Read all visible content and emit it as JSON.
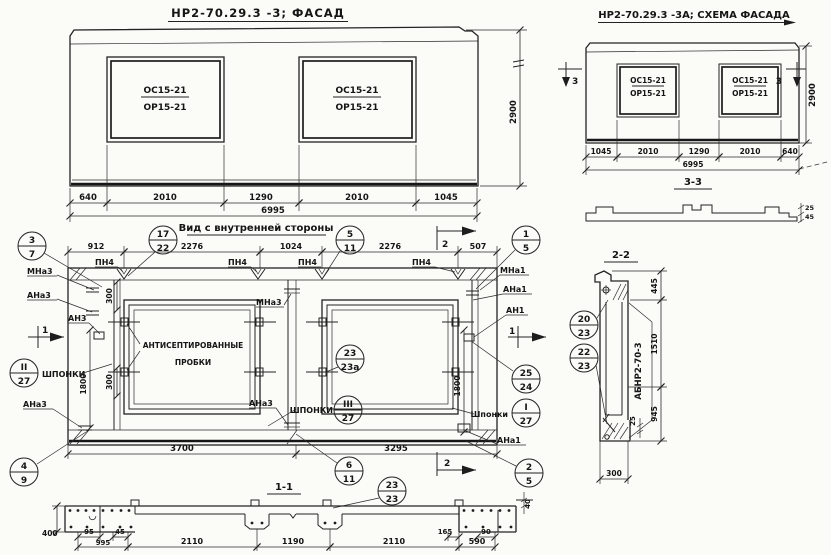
{
  "palette": {
    "ink": "#232323",
    "paper": "#fbfbf8"
  },
  "facade": {
    "title": "НР2-70.29.3 -3;  ФАСАД",
    "opening_top": "ОС15-21",
    "opening_bottom": "ОР15-21",
    "dims": [
      "640",
      "2010",
      "1290",
      "2010",
      "1045"
    ],
    "total": "6995",
    "height": "2900"
  },
  "scheme": {
    "title": "НР2-70.29.3 -3А; СХЕМА ФАСАДА",
    "opening_top": "ОС15-21",
    "opening_bottom": "ОР15-21",
    "dims": [
      "1045",
      "2010",
      "1290",
      "2010",
      "640"
    ],
    "total": "6995",
    "height": "2900",
    "section_mark": "3",
    "section_title": "3-3",
    "edge_dims": [
      "25",
      "45"
    ]
  },
  "interior": {
    "title": "Вид с внутренней стороны",
    "top_dims": [
      "912",
      "2276",
      "1024",
      "2276",
      "507"
    ],
    "bottom_dims": [
      "3700",
      "3295"
    ],
    "dim_300": "300",
    "dim_1800": "1800",
    "pn4": "ПН4",
    "plugs_note": [
      "АНТИСЕПТИРОВАННЫЕ",
      "ПРОБКИ"
    ],
    "labels": {
      "mna3": "МНа3",
      "ana3": "АНа3",
      "an3": "АН3",
      "mna1": "МНа1",
      "ana1": "АНа1",
      "an1": "АН1",
      "shponki": "Шпонки",
      "shponki2": "ШПОНКИ"
    },
    "marks": {
      "s1": "1",
      "s2": "2"
    },
    "callouts": {
      "c3_7": [
        "3",
        "7"
      ],
      "c17_22": [
        "17",
        "22"
      ],
      "c5_11": [
        "5",
        "11"
      ],
      "c1_5": [
        "1",
        "5"
      ],
      "c25_24": [
        "25",
        "24"
      ],
      "c1r_27": [
        "I",
        "27"
      ],
      "c2r_27": [
        "II",
        "27"
      ],
      "c3r_27": [
        "III",
        "27"
      ],
      "c4_9": [
        "4",
        "9"
      ],
      "c2_5": [
        "2",
        "5"
      ],
      "c6_11": [
        "6",
        "11"
      ],
      "c23_23a": [
        "23",
        "23а"
      ]
    }
  },
  "section_1_1": {
    "title": "1-1",
    "callout": [
      "23",
      "23"
    ],
    "dims_main": [
      "2110",
      "1190",
      "2110",
      "590"
    ],
    "dims_left": [
      "95",
      "45",
      "995"
    ],
    "dims_right": [
      "165",
      "90"
    ],
    "dim_400": "400",
    "dim_40": "40"
  },
  "section_2_2": {
    "title": "2-2",
    "callout_20_23": [
      "20",
      "23"
    ],
    "callout_22_23": [
      "22",
      "23"
    ],
    "item_mark": "АБНР2-70-3",
    "dims_v": [
      "445",
      "1510",
      "945"
    ],
    "dim_25": "25",
    "dim_300": "300"
  }
}
